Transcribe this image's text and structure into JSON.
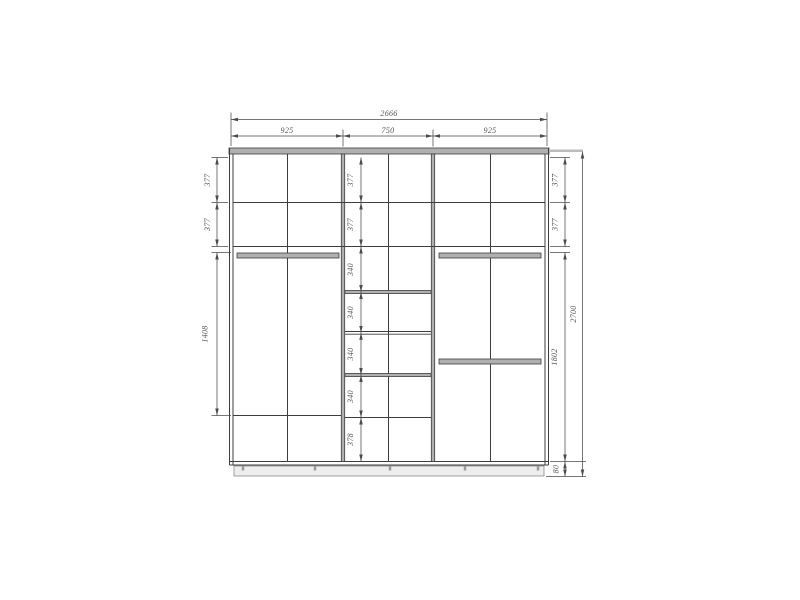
{
  "drawing": {
    "kind": "wardrobe-front-elevation",
    "dimensions": {
      "overall_width": "2666",
      "overall_height": "2700",
      "sections": [
        "925",
        "750",
        "925"
      ],
      "left_chain": [
        "377",
        "377",
        "1408"
      ],
      "center_chain": [
        "377",
        "377",
        "340",
        "340",
        "340",
        "340",
        "378"
      ],
      "right_chain": [
        "377",
        "377",
        "1802",
        "80"
      ]
    },
    "colors": {
      "line": "#3d3d3d",
      "dim_line": "#4a4a4a",
      "panel_fill": "#b0b0b0",
      "text": "#555555",
      "background": "#ffffff"
    }
  }
}
